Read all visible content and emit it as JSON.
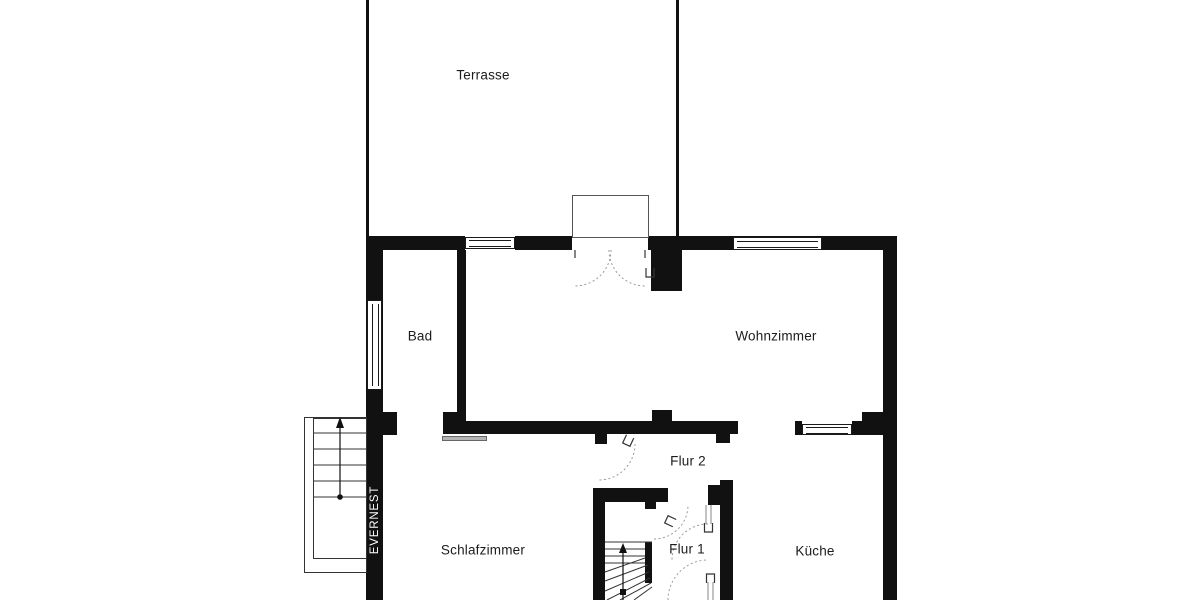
{
  "floorplan": {
    "watermark": "EVERNEST",
    "rooms": {
      "terrasse": {
        "label": "Terrasse"
      },
      "bad": {
        "label": "Bad"
      },
      "wohnzimmer": {
        "label": "Wohnzimmer"
      },
      "flur2": {
        "label": "Flur 2"
      },
      "schlafzimmer": {
        "label": "Schlafzimmer"
      },
      "flur1": {
        "label": "Flur 1"
      },
      "kueche": {
        "label": "Küche"
      }
    },
    "colors": {
      "wall": "#111111",
      "background": "#ffffff",
      "label_text": "#1c1c1c",
      "watermark_text": "#ffffff"
    }
  }
}
